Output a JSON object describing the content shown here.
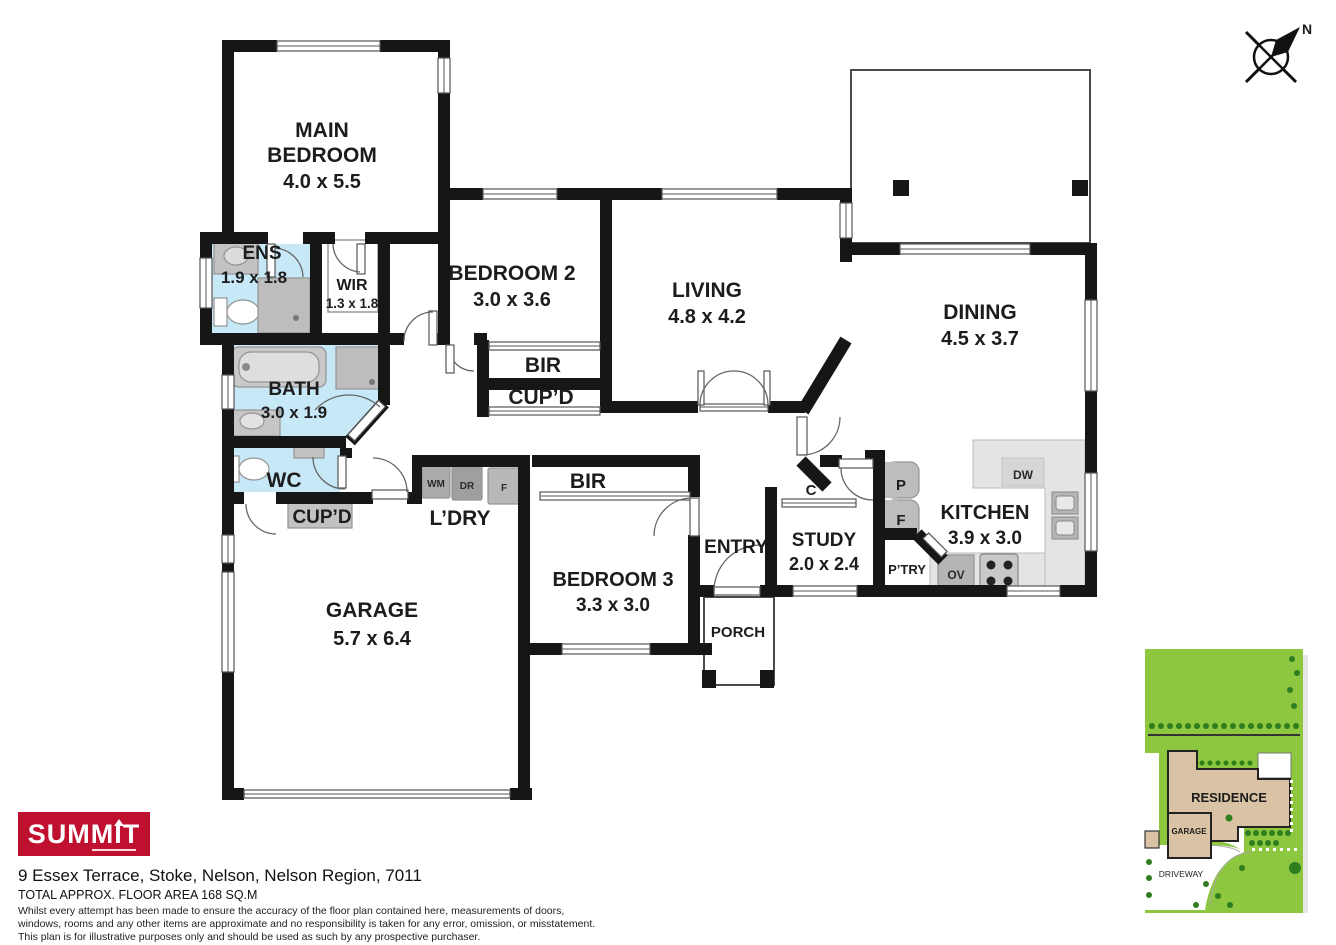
{
  "colors": {
    "wall": "#161616",
    "wet_area": "#c7e8f7",
    "site_green": "#8dc63f",
    "tree_green": "#2e7d1f",
    "brand_red": "#c01030",
    "residence_tan": "#d9c3a4"
  },
  "compass": {
    "label": "N"
  },
  "rooms": {
    "main_bedroom": {
      "line1": "MAIN",
      "line2": "BEDROOM",
      "dims": "4.0 x 5.5"
    },
    "ens": {
      "label": "ENS",
      "dims": "1.9 x 1.8"
    },
    "wir": {
      "label": "WIR",
      "dims": "1.3 x 1.8"
    },
    "bedroom2": {
      "label": "BEDROOM 2",
      "dims": "3.0 x 3.6"
    },
    "living": {
      "label": "LIVING",
      "dims": "4.8 x 4.2"
    },
    "dining": {
      "label": "DINING",
      "dims": "4.5 x 3.7"
    },
    "bath": {
      "label": "BATH",
      "dims": "3.0 x 1.9"
    },
    "wc": {
      "label": "WC"
    },
    "bir_upper": {
      "label": "BIR"
    },
    "cupd_upper": {
      "label": "CUP’D"
    },
    "cupd_lower": {
      "label": "CUP’D"
    },
    "ldry": {
      "label": "L’DRY"
    },
    "bir_lower": {
      "label": "BIR"
    },
    "bedroom3": {
      "label": "BEDROOM 3",
      "dims": "3.3 x 3.0"
    },
    "garage": {
      "label": "GARAGE",
      "dims": "5.7 x 6.4"
    },
    "entry": {
      "label": "ENTRY"
    },
    "porch": {
      "label": "PORCH"
    },
    "study": {
      "label": "STUDY",
      "dims": "2.0 x 2.4"
    },
    "closet": {
      "label": "C"
    },
    "kitchen": {
      "label": "KITCHEN",
      "dims": "3.9 x 3.0"
    },
    "pantry": {
      "label": "P’TRY"
    }
  },
  "appliances": {
    "wm": "WM",
    "dr": "DR",
    "f_laundry": "F",
    "dw": "DW",
    "ov": "OV",
    "p": "P",
    "f_kitchen": "F"
  },
  "siteplan": {
    "residence": "RESIDENCE",
    "garage": "GARAGE",
    "driveway": "DRIVEWAY"
  },
  "branding": {
    "logo": "SUMMIT"
  },
  "footer": {
    "address": "9 Essex Terrace, Stoke, Nelson, Nelson Region, 7011",
    "area": "TOTAL APPROX. FLOOR AREA 168 SQ.M",
    "disclaimer_line1": "Whilst every attempt has been made to ensure the accuracy of the floor plan contained here, measurements of doors,",
    "disclaimer_line2": "windows, rooms and any other items are approximate and no responsibility is taken for any error, omission, or misstatement.",
    "disclaimer_line3": "This plan is for illustrative purposes only and should be used as such by any prospective purchaser."
  }
}
